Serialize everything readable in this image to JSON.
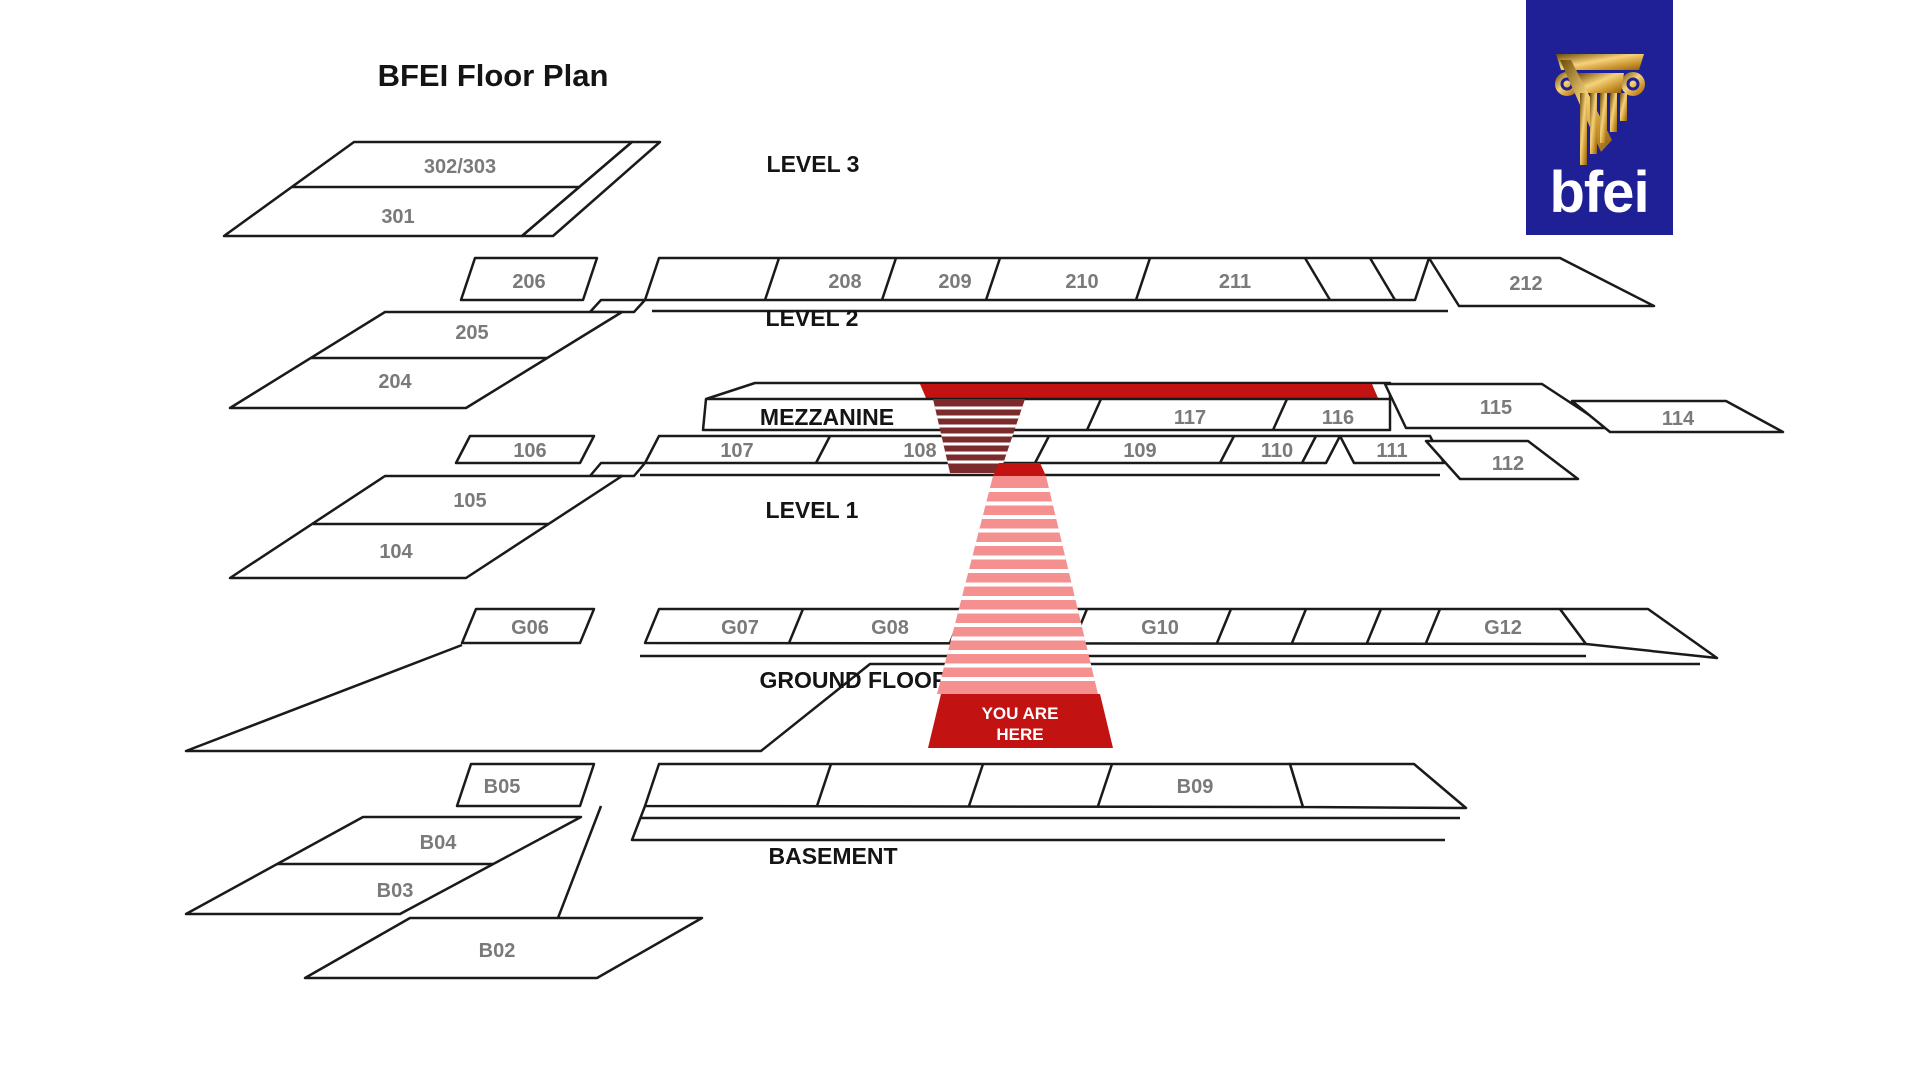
{
  "title": "BFEI Floor Plan",
  "logo": {
    "text": "bfei",
    "icon": "column-icon"
  },
  "marker": {
    "line1": "YOU ARE",
    "line2": "HERE"
  },
  "levels": [
    {
      "label": "LEVEL 3",
      "rooms": [
        "302/303",
        "301"
      ]
    },
    {
      "label": "LEVEL 2",
      "rooms": [
        "206",
        "208",
        "209",
        "210",
        "211",
        "212",
        "205",
        "204"
      ]
    },
    {
      "label": "MEZZANINE",
      "rooms": [
        "117",
        "116",
        "115",
        "114"
      ]
    },
    {
      "label": "LEVEL 1",
      "rooms": [
        "106",
        "107",
        "108",
        "109",
        "110",
        "111",
        "112",
        "105",
        "104"
      ]
    },
    {
      "label": "GROUND FLOOR",
      "rooms": [
        "G06",
        "G07",
        "G08",
        "G10",
        "G12"
      ]
    },
    {
      "label": "BASEMENT",
      "rooms": [
        "B05",
        "B09",
        "B04",
        "B03",
        "B02"
      ]
    }
  ],
  "colors": {
    "accent_red": "#c21212",
    "stair_maroon": "#7b2b2b",
    "path_pink": "#f49090",
    "logo_navy": "#1f1f96",
    "outline": "#1a1a1a",
    "room_label": "#7a7a7a"
  }
}
